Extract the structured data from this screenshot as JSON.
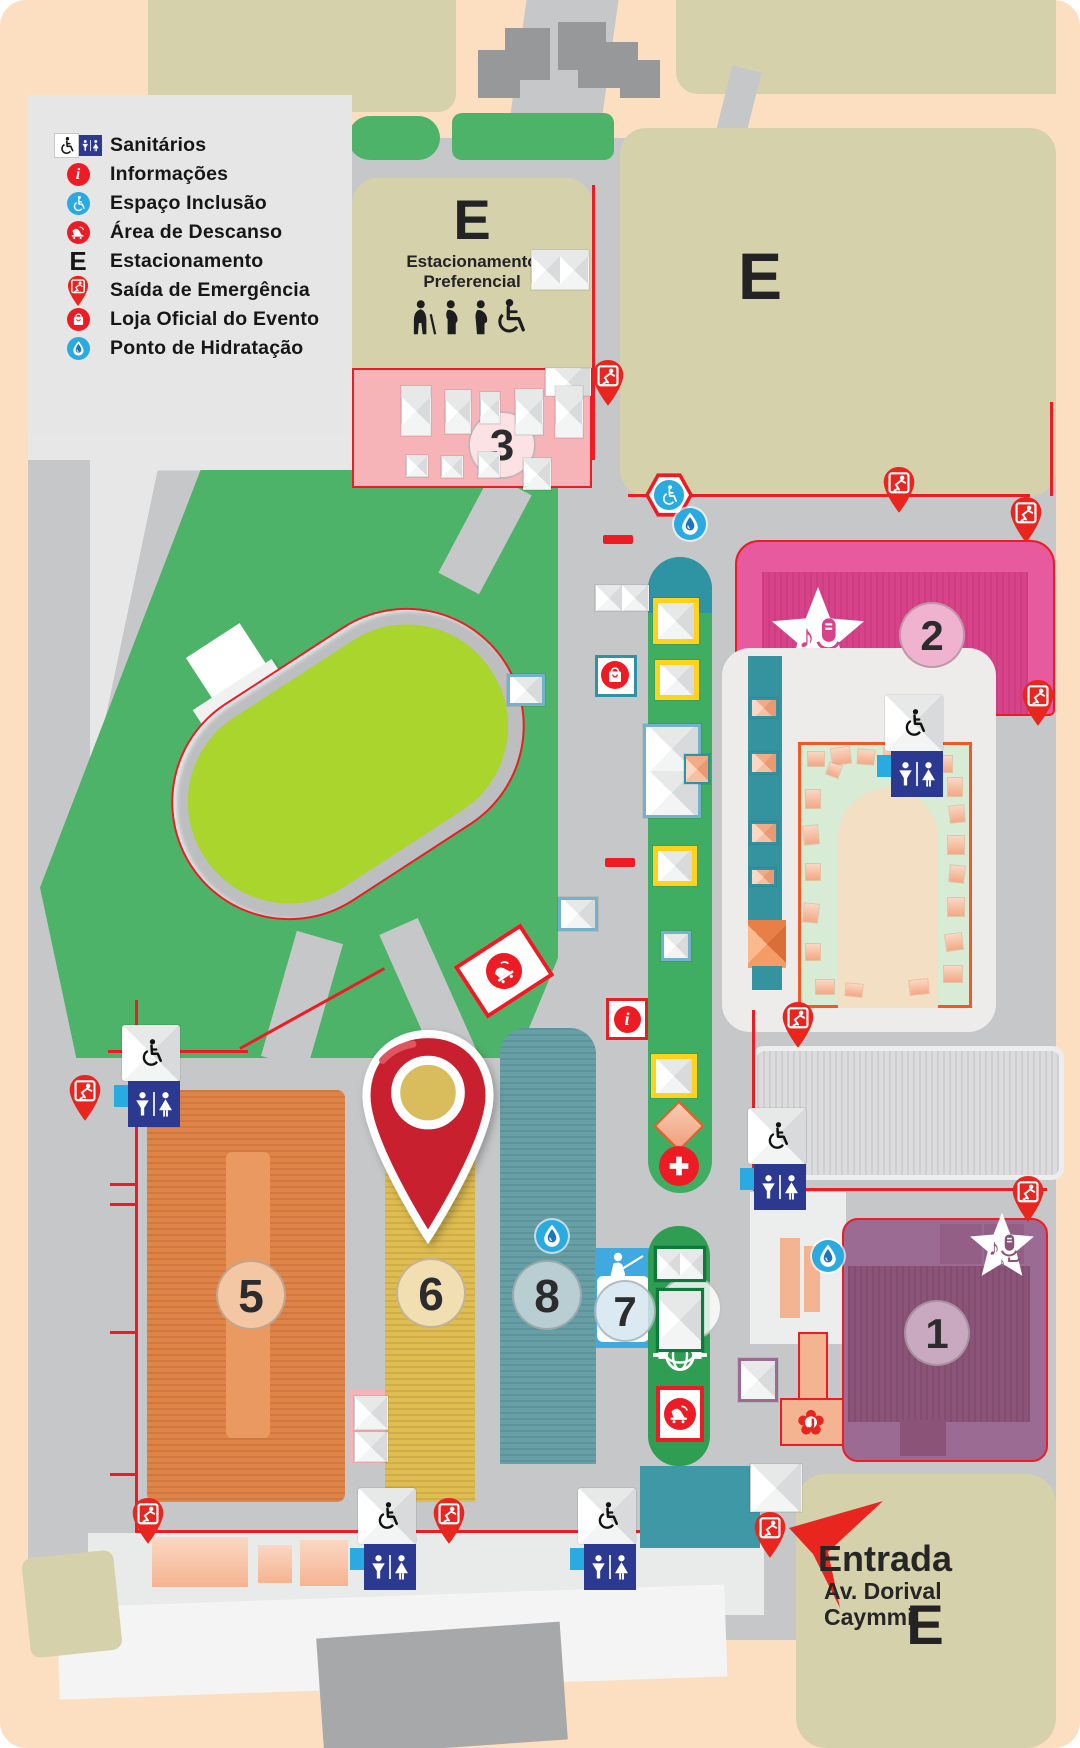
{
  "legend": {
    "items": [
      {
        "label": "Sanitários",
        "icon": "restroom-icon"
      },
      {
        "label": "Informações",
        "icon": "info-icon"
      },
      {
        "label": "Espaço Inclusão",
        "icon": "inclusion-icon"
      },
      {
        "label": "Área de Descanso",
        "icon": "rest-area-icon"
      },
      {
        "label": "Estacionamento",
        "icon": "parking-letter-icon"
      },
      {
        "label": "Saída de Emergência",
        "icon": "emergency-exit-icon"
      },
      {
        "label": "Loja Oficial do Evento",
        "icon": "official-store-icon"
      },
      {
        "label": "Ponto de Hidratação",
        "icon": "hydration-icon"
      }
    ],
    "parking_letter": "E"
  },
  "parking": {
    "preferential": {
      "letter": "E",
      "line1": "Estacionamento",
      "line2": "Preferencial"
    },
    "top_right_letter": "E",
    "bottom_right_letter": "E"
  },
  "areas": {
    "numbers": [
      "1",
      "2",
      "3",
      "4",
      "5",
      "6",
      "7",
      "8"
    ]
  },
  "entrance": {
    "title": "Entrada",
    "street_line1": "Av. Dorival",
    "street_line2": "Caymmi"
  },
  "map_icons": [
    "restroom-icon",
    "info-icon",
    "inclusion-icon",
    "rest-area-icon",
    "emergency-exit-icon",
    "official-store-icon",
    "hydration-icon",
    "first-aid-icon",
    "stage-star-music-icon",
    "statue-icon",
    "lantern-icon",
    "flower-icon",
    "priority-persons-icon",
    "location-pin-icon",
    "entrance-arrow-icon"
  ],
  "colors": {
    "accent_red": "#ed1c24",
    "stage_pink": "#e85a9e",
    "area1_purple": "#9c6b94",
    "area5_orange": "#df8346",
    "area6_yellow": "#e0bd50",
    "area7_blue": "#3fa9e0",
    "area8_teal": "#679fa7",
    "walkway_green": "#3fae63",
    "park_green": "#4db368",
    "field_lime": "#a9d52c",
    "parking_khaki": "#d5d2ab",
    "restroom_blue": "#2b3990",
    "hydration_blue": "#29abe2",
    "background_peach": "#fcdfc0"
  }
}
